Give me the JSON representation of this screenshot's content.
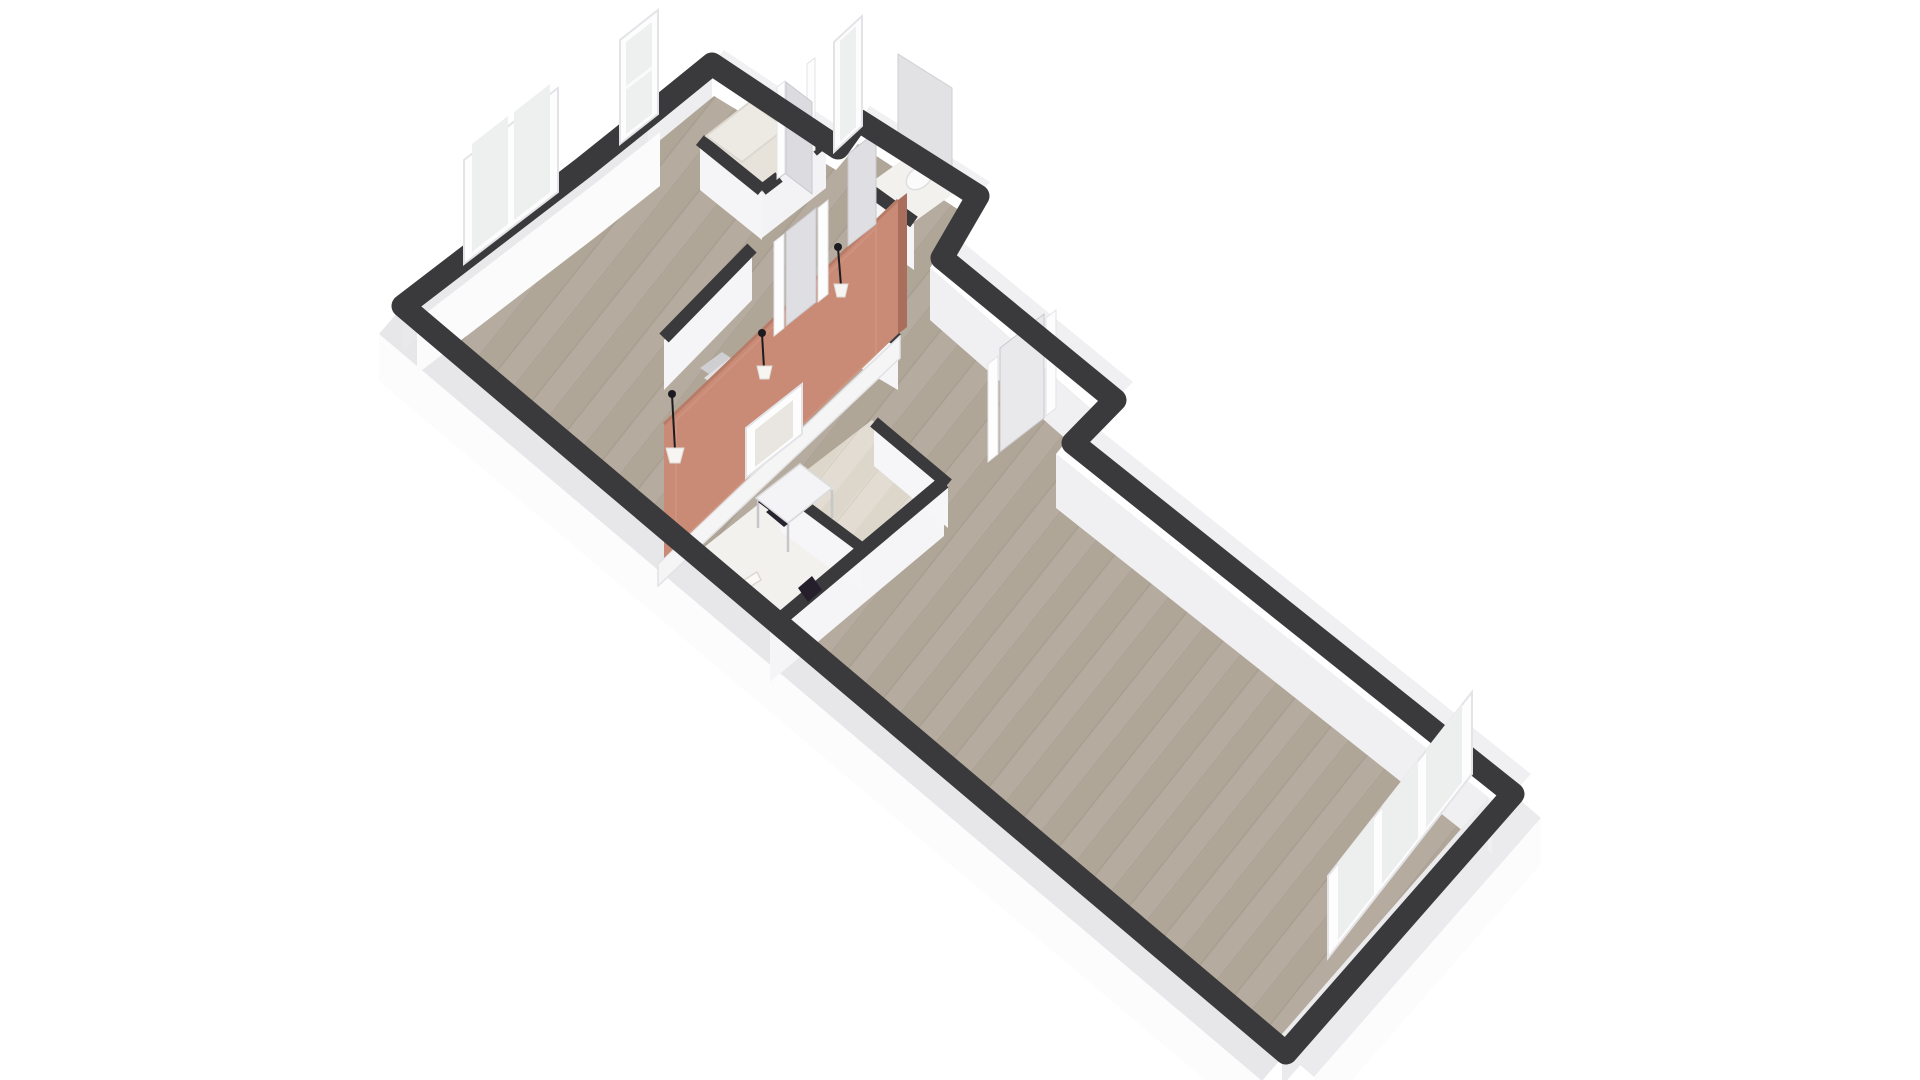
{
  "meta": {
    "app": "floorplan-3d-render",
    "description": "Isometric 3D render of an elongated apartment floor plan on a white background, viewed from the south-west corner"
  },
  "scene": {
    "background": "#ffffff",
    "colors": {
      "wall_cap": "#3a3a3c",
      "wall_face_light": "#fbfbfc",
      "wall_face_inner": "#f5f5f7",
      "wall_face_shaded": "#e9e9ec",
      "wall_face_far": "#f0f0f2",
      "plinth_top": "#e7e7ea",
      "plinth_face": "#fcfcfd",
      "wood_floor": "#b5ab9e",
      "wood_plank_dark": "#aba192",
      "wood_plank_line": "#9c9285",
      "pale_floor": "#e2dcd2",
      "pale_plank": "#d8d2c6",
      "tile_floor": "#f2f1ee",
      "shower_floor": "#e7e2da",
      "accent_wall": "#c98b76",
      "accent_wall_side": "#a96f5c",
      "accent_wall_edge": "#b77c67",
      "accent_highlight": "#d49a86",
      "frame_white": "#fdfdfe",
      "frame_stroke": "#e4e4e8",
      "glass": "#eef0ef",
      "door_leaf": "#dfdfe3",
      "door_leaf_stroke": "#c9c9ce",
      "fixture_white": "#fbfbfc",
      "fixture_stroke": "#dde0e1",
      "furniture_dark": "#27242f",
      "pendant_dark": "#1c1c20",
      "lamp_shade": "#f6f5f2"
    },
    "rooms": [
      {
        "name": "living-room-west",
        "floor": "wood",
        "features": [
          "double-window",
          "open-plan"
        ]
      },
      {
        "name": "salon-area",
        "floor": "wood",
        "features": [
          "accent-partition-wall",
          "pendant-lamps",
          "armchair"
        ]
      },
      {
        "name": "hallway",
        "floor": "wood",
        "features": [
          "entry-door",
          "interior-doors"
        ]
      },
      {
        "name": "shower-room",
        "floor": "pale-tile",
        "features": [
          "shower-tray",
          "tall-window",
          "door"
        ]
      },
      {
        "name": "wc",
        "floor": "tile",
        "features": [
          "toilet",
          "tall-window",
          "door"
        ]
      },
      {
        "name": "office-nook",
        "floor": "pale-wood",
        "features": [
          "desk",
          "chair",
          "leaning-mirror"
        ]
      },
      {
        "name": "bathroom",
        "floor": "tile",
        "features": [
          "towel",
          "bath-mat"
        ]
      },
      {
        "name": "large-room-east",
        "floor": "wood",
        "features": [
          "triple-window",
          "door"
        ]
      }
    ],
    "windows": [
      {
        "name": "double-casement-window",
        "panes": 2,
        "wall": "north-west"
      },
      {
        "name": "tall-window-1",
        "panes": 1,
        "wall": "north-west-protrusion"
      },
      {
        "name": "tall-window-2",
        "panes": 1,
        "wall": "north-west-wc"
      },
      {
        "name": "triple-window",
        "panes": 3,
        "wall": "south-east-end"
      }
    ],
    "doors": [
      {
        "name": "entry-door",
        "state": "closed"
      },
      {
        "name": "shower-door",
        "state": "open"
      },
      {
        "name": "wc-door",
        "state": "open"
      },
      {
        "name": "hall-door",
        "state": "open"
      },
      {
        "name": "large-room-door",
        "state": "open"
      }
    ],
    "furniture": [
      {
        "name": "desk"
      },
      {
        "name": "desk-chair"
      },
      {
        "name": "armchair"
      },
      {
        "name": "leaning-mirror"
      },
      {
        "name": "toilet"
      },
      {
        "name": "towel"
      },
      {
        "name": "pendant-lamp",
        "count": 3
      }
    ],
    "accent_wall": {
      "color_name": "terracotta",
      "hex": "#c98b76"
    }
  }
}
